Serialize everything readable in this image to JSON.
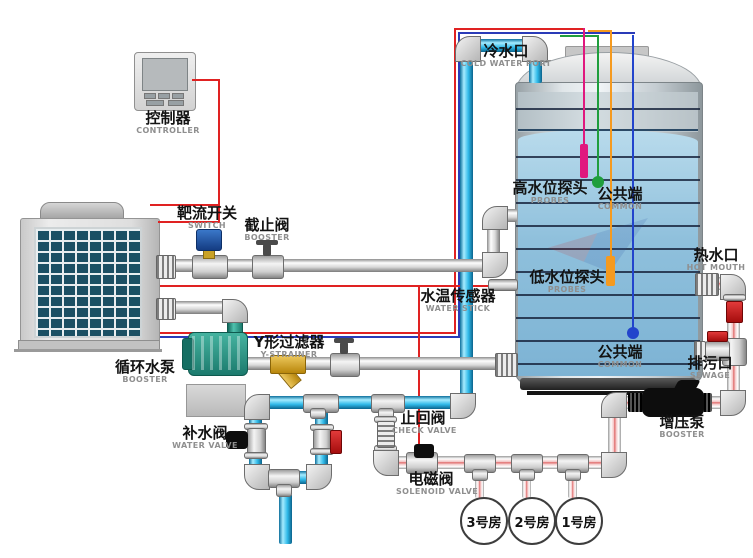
{
  "diagram_title": "heat-pump hot water system schematic",
  "colors": {
    "wire_red": "#e02222",
    "wire_navy": "#2a3bb8",
    "probe_magenta": "#e0187e",
    "probe_green": "#1f9e3c",
    "probe_orange": "#f59a1f",
    "probe_blue": "#2244cc",
    "pipe_cyan": "#2fb9e8",
    "pipe_pink": "#e06a6a",
    "strainer_yellow": "#d9a425",
    "pump_teal": "#2e8f7f",
    "switch_blue": "#1d4f9e",
    "valve_red": "#c41414"
  },
  "labels": {
    "controller": {
      "zh": "控制器",
      "en": "CONTROLLER"
    },
    "flow_switch": {
      "zh": "靶流开关",
      "en": "SWITCH"
    },
    "stop_valve": {
      "zh": "截止阀",
      "en": "BOOSTER"
    },
    "cold_port": {
      "zh": "冷水口",
      "en": "COLD WATER PORT"
    },
    "high_probe": {
      "zh": "高水位探头",
      "en": "PROBES"
    },
    "common_top": {
      "zh": "公共端",
      "en": "COMMON"
    },
    "low_probe": {
      "zh": "低水位探头",
      "en": "PROBES"
    },
    "common_bottom": {
      "zh": "公共端",
      "en": "COMMON"
    },
    "hot_port": {
      "zh": "热水口",
      "en": "HOT MOUTH"
    },
    "sewage": {
      "zh": "排污口",
      "en": "SEWAGE"
    },
    "booster_pump": {
      "zh": "增压泵",
      "en": "BOOSTER"
    },
    "temp_sensor": {
      "zh": "水温传感器",
      "en": "WATER STICK"
    },
    "y_strainer": {
      "zh": "Y形过滤器",
      "en": "Y-STRAINER"
    },
    "circ_pump": {
      "zh": "循环水泵",
      "en": "BOOSTER"
    },
    "makeup_valve": {
      "zh": "补水阀",
      "en": "WATER VALVE"
    },
    "check_valve": {
      "zh": "止回阀",
      "en": "CHECK VALVE"
    },
    "solenoid": {
      "zh": "电磁阀",
      "en": "SOLENOID VALVE"
    },
    "room3": {
      "zh": "3号房"
    },
    "room2": {
      "zh": "2号房"
    },
    "room1": {
      "zh": "1号房"
    }
  }
}
